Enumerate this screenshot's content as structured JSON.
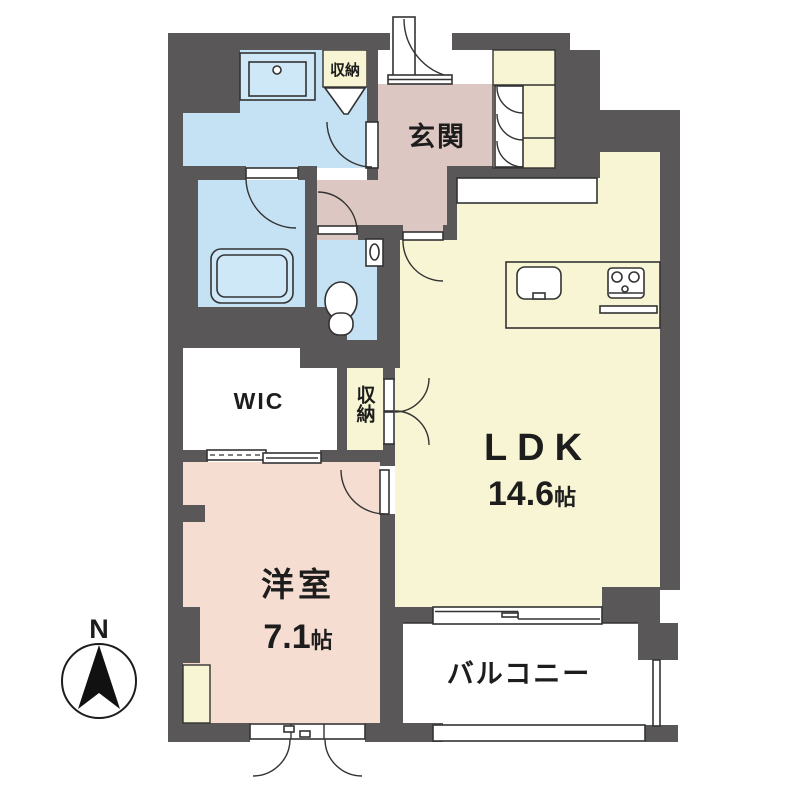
{
  "plan": {
    "entrance": {
      "label": "玄関"
    },
    "closet_entrance": {
      "label": "収納"
    },
    "closet_ldk": {
      "label": "収納"
    },
    "wic": {
      "label": "WIC"
    },
    "ldk": {
      "label": "LDK",
      "size_num": "14.6",
      "size_unit": "帖"
    },
    "western_room": {
      "label": "洋室",
      "size_num": "7.1",
      "size_unit": "帖"
    },
    "balcony": {
      "label": "バルコニー"
    },
    "compass": {
      "label": "N"
    }
  },
  "colors": {
    "wall": "#595757",
    "wet_area_blue": "#c5e2f4",
    "entrance_hall_pink": "#ddc7c2",
    "western_room_pink": "#f6ddd2",
    "ldk_yellow": "#f7f5d3",
    "outline": "#333333"
  }
}
